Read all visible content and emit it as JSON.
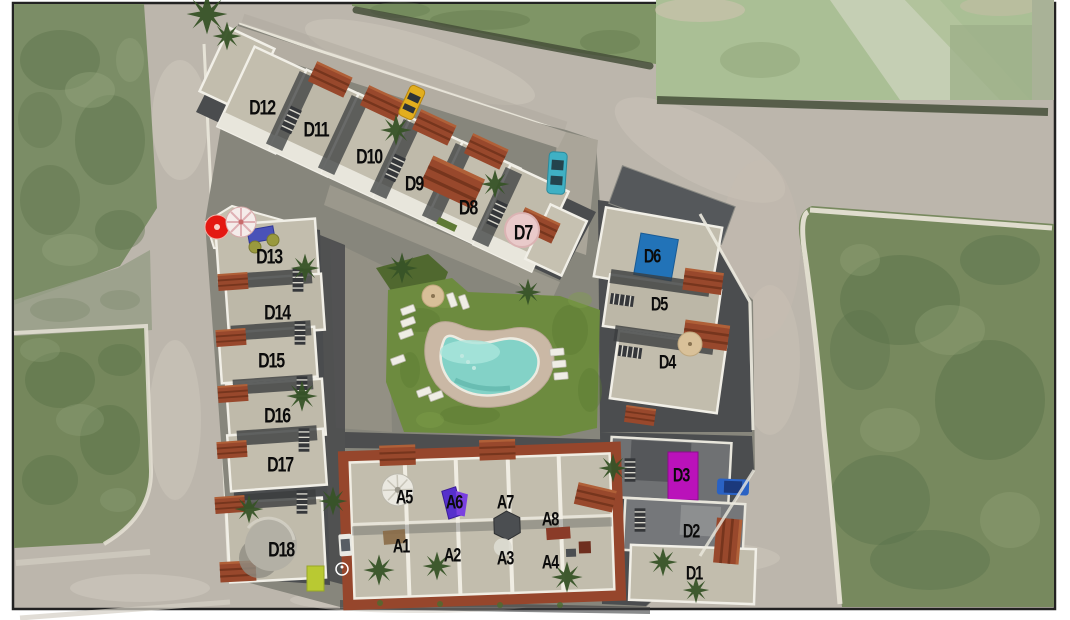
{
  "page": {
    "margin_color": "#ffffff",
    "frame_color": "#222222",
    "kind": "aerial-site-plan-render"
  },
  "plan": {
    "building_labels": {
      "d1": "D1",
      "d2": "D2",
      "d3": "D3",
      "d4": "D4",
      "d5": "D5",
      "d6": "D6",
      "d7": "D7",
      "d8": "D8",
      "d9": "D9",
      "d10": "D10",
      "d11": "D11",
      "d12": "D12",
      "d13": "D13",
      "d14": "D14",
      "d15": "D15",
      "d16": "D16",
      "d17": "D17",
      "d18": "D18",
      "a1": "A1",
      "a2": "A2",
      "a3": "A3",
      "a4": "A4",
      "a5": "A5",
      "a6": "A6",
      "a7": "A7",
      "a8": "A8"
    },
    "zones": {
      "d_top_row": [
        "D12",
        "D11",
        "D10",
        "D9",
        "D8",
        "D7"
      ],
      "d_left_column": [
        "D13",
        "D14",
        "D15",
        "D16",
        "D17",
        "D18"
      ],
      "d_right_column": [
        "D6",
        "D5",
        "D4",
        "D3",
        "D2",
        "D1"
      ],
      "a_block_upper_row": [
        "A5",
        "A6",
        "A7",
        "A8"
      ],
      "a_block_lower_row": [
        "A1",
        "A2",
        "A3",
        "A4"
      ]
    },
    "symbols": {
      "disabled_parking": "♿"
    },
    "highlight_colors": {
      "d6_solarium_blue": "#2273b8",
      "d3_unit_magenta": "#ba12ba",
      "a6_unit_purple": "#5630cc",
      "d13_sunbed_blue": "#4a52b8",
      "red_umbrella": "#e41812",
      "pool_water": "#83d2c7",
      "lawn_green": "#6d8b3f",
      "deck_tan": "#cab8a5",
      "terracotta_roof": "#98482c",
      "chartreuse_panel": "#b9c932"
    },
    "vehicles": {
      "yellow_car": "#e2ae1e",
      "teal_car": "#3fb0c4",
      "blue_car": "#2a62c4",
      "white_car": "#e9e9e3"
    }
  }
}
